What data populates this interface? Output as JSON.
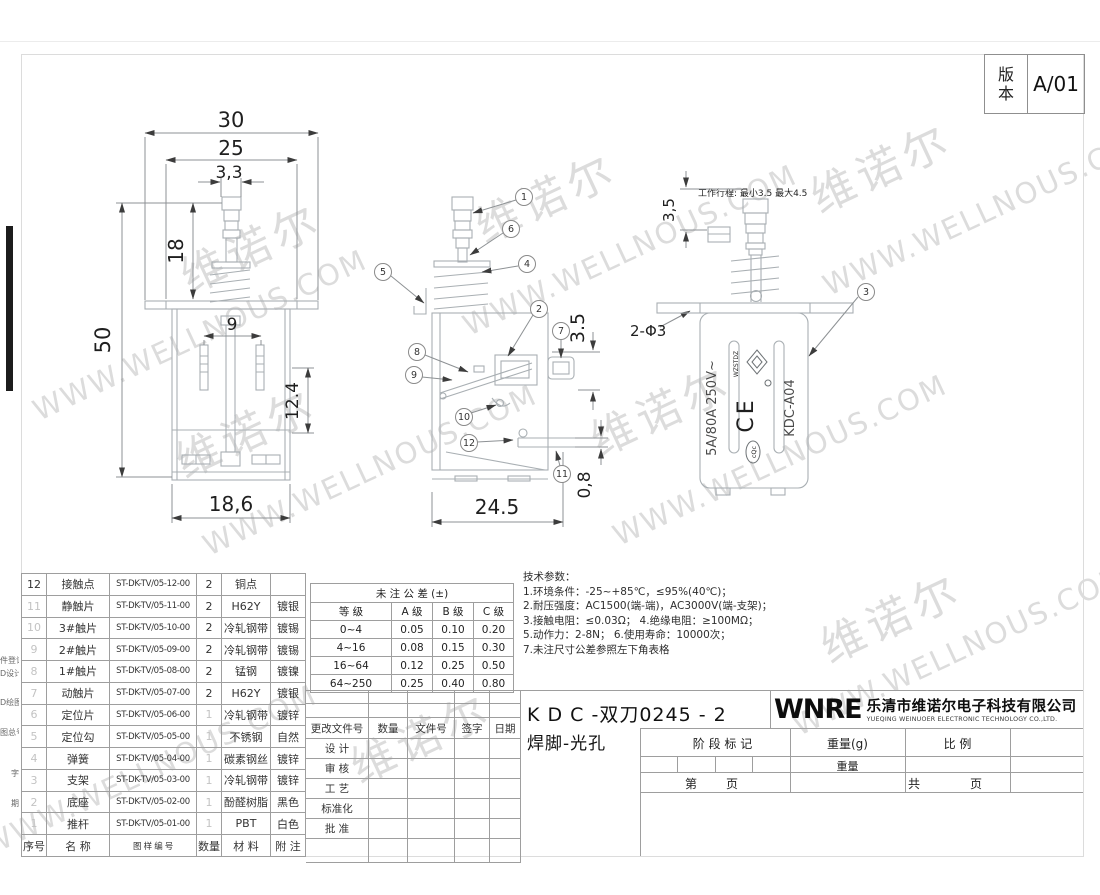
{
  "sheet": {
    "revision_label": "版本",
    "revision_value": "A/01"
  },
  "watermark": {
    "cn": "维诺尔",
    "en": "WWW.WELLNOUS.COM"
  },
  "front_view": {
    "dim_30": "30",
    "dim_25": "25",
    "dim_3_3": "3,3",
    "dim_18": "18",
    "dim_50": "50",
    "dim_9": "9",
    "dim_12_4": "12.4",
    "dim_18_6": "18,6"
  },
  "section_view": {
    "dim_3_5": "3.5",
    "dim_24_5": "24.5",
    "dim_0_8": "0,8",
    "callouts": {
      "c1": "1",
      "c2": "2",
      "c4": "4",
      "c5": "5",
      "c6": "6",
      "c7": "7",
      "c8": "8",
      "c9": "9",
      "c10": "10",
      "c11": "11",
      "c12": "12"
    }
  },
  "side_view": {
    "callout_3": "3",
    "stroke_note": "工作行程: 最小3.5 最大4.5",
    "dim_3_5": "3,5",
    "dim_holes": "2-Φ3",
    "marking_rating": "5A/80A 250V~",
    "marking_ce": "CE",
    "marking_model": "KDC-A04",
    "marking_cqc": "cQc",
    "marking_logo": "WZSTDZ"
  },
  "bom": {
    "headers": {
      "no": "序号",
      "name": "名  称",
      "code": "图 样 编 号",
      "qty": "数量",
      "material": "材  料",
      "note": "附 注"
    },
    "rows": [
      {
        "no": "12",
        "name": "接触点",
        "code": "ST-DK-TV/05-12-00",
        "qty": "2",
        "material": "铜点",
        "note": ""
      },
      {
        "no": "11",
        "name": "静触片",
        "code": "ST-DK-TV/05-11-00",
        "qty": "2",
        "material": "H62Y",
        "note": "镀银"
      },
      {
        "no": "10",
        "name": "3#触片",
        "code": "ST-DK-TV/05-10-00",
        "qty": "2",
        "material": "冷轧钢带",
        "note": "镀锡"
      },
      {
        "no": "9",
        "name": "2#触片",
        "code": "ST-DK-TV/05-09-00",
        "qty": "2",
        "material": "冷轧钢带",
        "note": "镀锡"
      },
      {
        "no": "8",
        "name": "1#触片",
        "code": "ST-DK-TV/05-08-00",
        "qty": "2",
        "material": "锰钢",
        "note": "镀镍"
      },
      {
        "no": "7",
        "name": "动触片",
        "code": "ST-DK-TV/05-07-00",
        "qty": "2",
        "material": "H62Y",
        "note": "镀银"
      },
      {
        "no": "6",
        "name": "定位片",
        "code": "ST-DK-TV/05-06-00",
        "qty": "1",
        "material": "冷轧钢带",
        "note": "镀锌"
      },
      {
        "no": "5",
        "name": "定位勾",
        "code": "ST-DK-TV/05-05-00",
        "qty": "1",
        "material": "不锈钢",
        "note": "自然"
      },
      {
        "no": "4",
        "name": "弹簧",
        "code": "ST-DK-TV/05-04-00",
        "qty": "1",
        "material": "碳素钢丝",
        "note": "镀锌"
      },
      {
        "no": "3",
        "name": "支架",
        "code": "ST-DK-TV/05-03-00",
        "qty": "1",
        "material": "冷轧钢带",
        "note": "镀锌"
      },
      {
        "no": "2",
        "name": "底座",
        "code": "ST-DK-TV/05-02-00",
        "qty": "1",
        "material": "酚醛树脂",
        "note": "黑色"
      },
      {
        "no": "1",
        "name": "推杆",
        "code": "ST-DK-TV/05-01-00",
        "qty": "1",
        "material": "PBT",
        "note": "白色"
      }
    ]
  },
  "tolerance": {
    "title": "未  注  公  差  (±)",
    "headers": [
      "等    级",
      "A 级",
      "B 级",
      "C 级"
    ],
    "rows": [
      [
        "0~4",
        "0.05",
        "0.10",
        "0.20"
      ],
      [
        "4~16",
        "0.08",
        "0.15",
        "0.30"
      ],
      [
        "16~64",
        "0.12",
        "0.25",
        "0.50"
      ],
      [
        "64~250",
        "0.25",
        "0.40",
        "0.80"
      ]
    ]
  },
  "tech": {
    "title": "技术参数：",
    "lines": [
      "1.环境条件：-25~+85℃，≤95%(40℃)；",
      "2.耐压强度：AC1500(端-端)，AC3000V(端-支架)；",
      "3.接触电阻：≤0.03Ω；             4.绝缘电阻：≥100MΩ；",
      "5.动作力：2-8N；         6.使用寿命：10000次；",
      "7.未注尺寸公差参照左下角表格"
    ]
  },
  "titleblock": {
    "rev_headers": [
      "更改文件号",
      "数量",
      "文件号",
      "签字",
      "日期"
    ],
    "sign_labels": [
      "设 计",
      "审 核",
      "工 艺",
      "标准化",
      "批 准"
    ],
    "part_code": "K D C -双刀0245 - 2",
    "part_name": "焊脚-光孔",
    "logo_text": "WNRE",
    "company_cn": "乐清市维诺尔电子科技有限公司",
    "company_en": "YUEQING WEINUOER ELECTRONIC TECHNOLOGY CO.,LTD.",
    "stage_label": "阶 段 标 记",
    "weight_label": "重量(g)",
    "scale_label": "比    例",
    "weight_row_label": "重量",
    "page_first": "第",
    "page_label1": "页",
    "page_total": "共",
    "page_label2": "页"
  },
  "margin_labels": [
    "件登记",
    "D设计",
    "D绘图",
    "图总号",
    "字",
    "期"
  ]
}
